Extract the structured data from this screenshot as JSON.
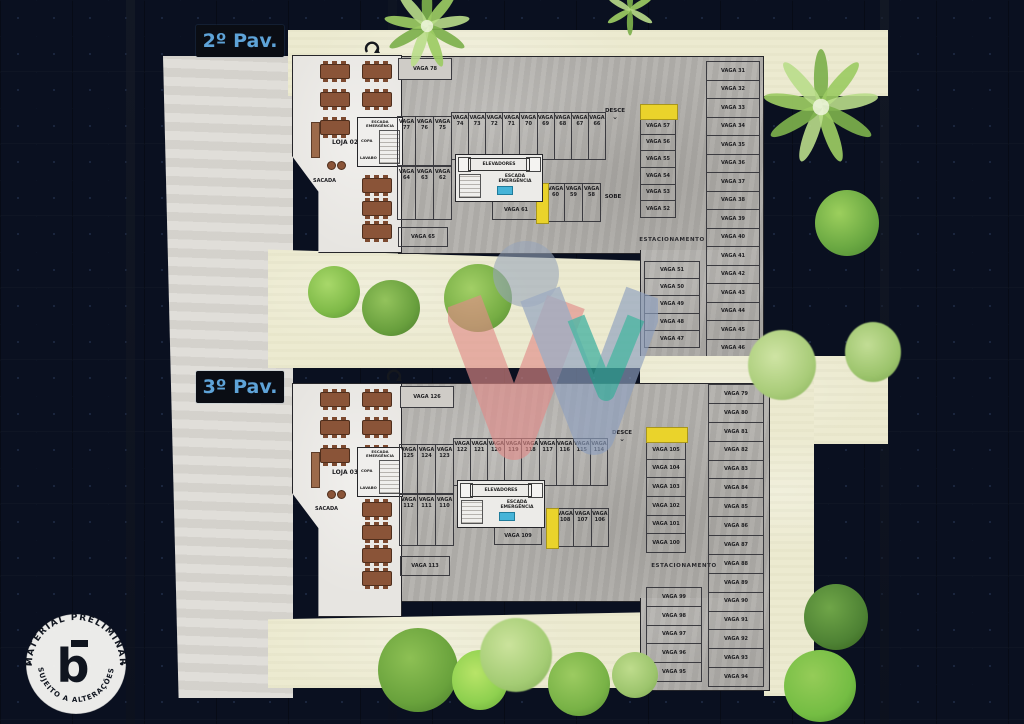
{
  "stamp": {
    "top_text": "MATERIAL PRELIMINAR",
    "bottom_text": "SUJEITO A ALTERAÇÕES",
    "letter": "b"
  },
  "colors": {
    "floor_tag_text": "#5ea3d8",
    "ramp_yellow": "#ead32b",
    "watermark_red": "#e08b88",
    "watermark_blue": "#8fa0bf",
    "watermark_teal": "#34ac9c",
    "lawn_beige": "#ecead0",
    "parking_gray": "#b2b0ac"
  },
  "floors": [
    {
      "label": "2º Pav.",
      "loja": {
        "label": "LOJA 02",
        "sacada": "SACADA",
        "copa": "COPA",
        "lavabo": "LAVABO",
        "escada": "ESCADA EMERGÊNCIA"
      },
      "core": {
        "elevadores": "ELEVADORES",
        "escada": "ESCADA EMERGÊNCIA"
      },
      "ramp_down": "DESCE",
      "ramp_up": "SOBE",
      "estacionamento": "ESTACIONAMENTO",
      "stalls": {
        "top": "VAGA 78",
        "bottom": "VAGA 65",
        "center": "VAGA 61",
        "row1_left": [
          "VAGA 77",
          "VAGA 76",
          "VAGA 75"
        ],
        "row1_right": [
          "VAGA 74",
          "VAGA 73",
          "VAGA 72",
          "VAGA 71",
          "VAGA 70",
          "VAGA 69",
          "VAGA 68",
          "VAGA 67",
          "VAGA 66"
        ],
        "row2_left": [
          "VAGA 64",
          "VAGA 63",
          "VAGA 62"
        ],
        "row2_right": [
          "VAGA 60",
          "VAGA 59",
          "VAGA 58"
        ],
        "mid_column": [
          "VAGA 57",
          "VAGA 56",
          "VAGA 55",
          "VAGA 54",
          "VAGA 53",
          "VAGA 52"
        ],
        "right_strip": [
          "VAGA 31",
          "VAGA 32",
          "VAGA 33",
          "VAGA 34",
          "VAGA 35",
          "VAGA 36",
          "VAGA 37",
          "VAGA 38",
          "VAGA 39",
          "VAGA 40",
          "VAGA 41",
          "VAGA 42",
          "VAGA 43",
          "VAGA 44",
          "VAGA 45",
          "VAGA 46"
        ],
        "lower_left_column": [
          "VAGA 51",
          "VAGA 50",
          "VAGA 49",
          "VAGA 48",
          "VAGA 47"
        ]
      }
    },
    {
      "label": "3º Pav.",
      "loja": {
        "label": "LOJA 03",
        "sacada": "SACADA",
        "copa": "COPA",
        "lavabo": "LAVABO",
        "escada": "ESCADA EMERGÊNCIA"
      },
      "core": {
        "elevadores": "ELEVADORES",
        "escada": "ESCADA EMERGÊNCIA"
      },
      "ramp_down": "DESCE",
      "estacionamento": "ESTACIONAMENTO",
      "stalls": {
        "top": "VAGA 126",
        "bottom": "VAGA 113",
        "center": "VAGA 109",
        "row1_left": [
          "VAGA 125",
          "VAGA 124",
          "VAGA 123"
        ],
        "row1_right": [
          "VAGA 122",
          "VAGA 121",
          "VAGA 120",
          "VAGA 119",
          "VAGA 118",
          "VAGA 117",
          "VAGA 116",
          "VAGA 115",
          "VAGA 114"
        ],
        "row2_left": [
          "VAGA 112",
          "VAGA 111",
          "VAGA 110"
        ],
        "row2_right": [
          "VAGA 108",
          "VAGA 107",
          "VAGA 106"
        ],
        "mid_column": [
          "VAGA 105",
          "VAGA 104",
          "VAGA 103",
          "VAGA 102",
          "VAGA 101",
          "VAGA 100"
        ],
        "right_strip": [
          "VAGA 79",
          "VAGA 80",
          "VAGA 81",
          "VAGA 82",
          "VAGA 83",
          "VAGA 84",
          "VAGA 85",
          "VAGA 86",
          "VAGA 87",
          "VAGA 88",
          "VAGA 89",
          "VAGA 90",
          "VAGA 91",
          "VAGA 92",
          "VAGA 93",
          "VAGA 94"
        ],
        "lower_left_column": [
          "VAGA 99",
          "VAGA 98",
          "VAGA 97",
          "VAGA 96",
          "VAGA 95"
        ]
      }
    }
  ]
}
